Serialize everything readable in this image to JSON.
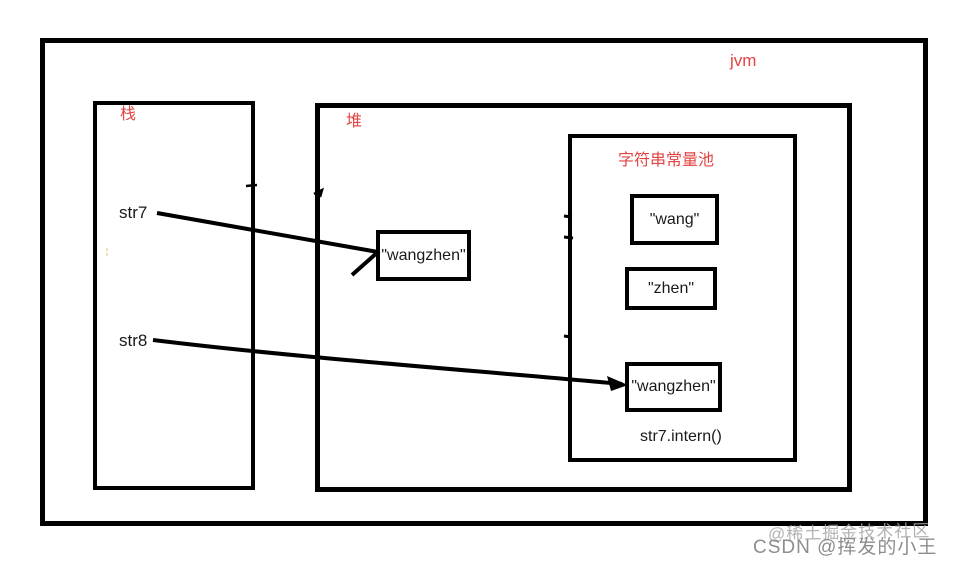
{
  "colors": {
    "label_red": "#e24444",
    "line_black": "#000000",
    "watermark_light": "#a5a5a5",
    "watermark_dark": "#878787",
    "background": "#ffffff"
  },
  "diagram": {
    "jvm_label": "jvm",
    "stack": {
      "label": "栈",
      "var1": "str7",
      "var2": "str8"
    },
    "heap": {
      "label": "堆",
      "wangzhen_box": "\"wangzhen\""
    },
    "pool": {
      "label": "字符串常量池",
      "wang_box": "\"wang\"",
      "zhen_box": "\"zhen\"",
      "wangzhen_box": "\"wangzhen\"",
      "caption": "str7.intern()"
    },
    "relations": [
      {
        "from": "str7",
        "to": "heap-wangzhen-box",
        "type": "arrow"
      },
      {
        "from": "str8",
        "to": "pool-wangzhen-box",
        "type": "arrow"
      }
    ]
  },
  "watermark": {
    "overlay": "@稀土掘金技术社区",
    "main": "CSDN @挥发的小王"
  }
}
